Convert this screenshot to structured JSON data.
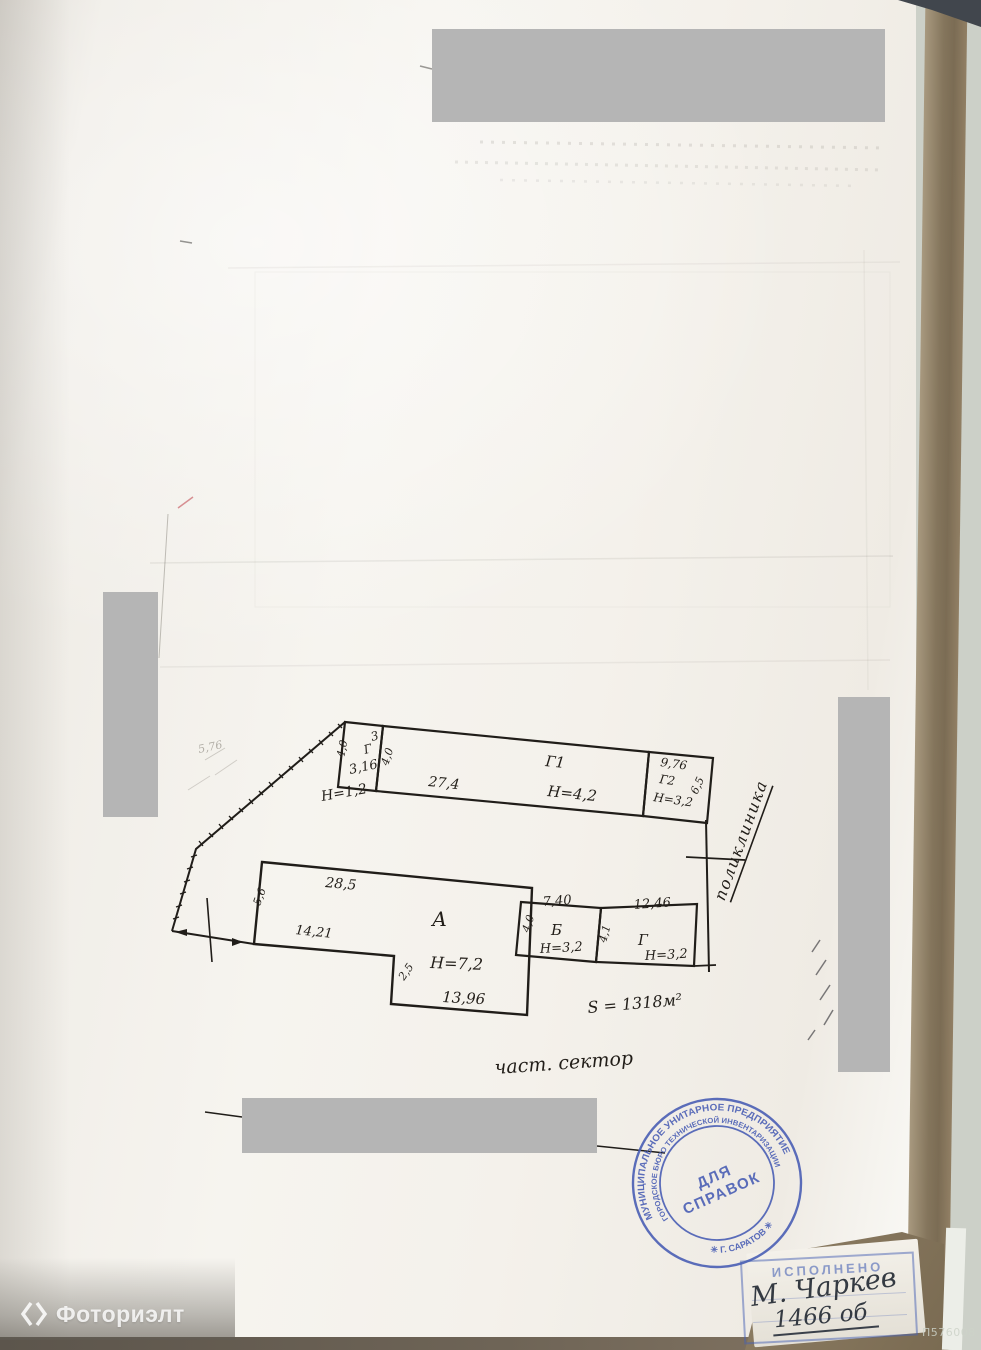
{
  "scan": {
    "code": "П576008"
  },
  "watermark": {
    "brand": "Фоториэлт"
  },
  "plan": {
    "shed3": {
      "num": "3",
      "letter": "Г",
      "width": "3,16",
      "side_left": "4,0",
      "side_right": "4,0",
      "height": "Н=1,2"
    },
    "g1": {
      "label": "Г1",
      "length": "27,4",
      "height": "Н=4,2"
    },
    "g2": {
      "label": "Г2",
      "width": "9,76",
      "height": "Н=3,2",
      "side": "6,5"
    },
    "a": {
      "label": "А",
      "top": "28,5",
      "left": "5,6",
      "offset": "14,21",
      "height": "Н=7,2",
      "bottom": "13,96",
      "step": "2,5"
    },
    "b": {
      "label": "Б",
      "top": "7,40",
      "side": "4,0",
      "height": "Н=3,2"
    },
    "g": {
      "label": "Г",
      "top": "12,46",
      "side": "4,1",
      "height": "Н=3,2"
    },
    "notes": {
      "area": "S = 1318м²",
      "sector": "част. сектор",
      "street": "поликлиника",
      "pencil": "5,76"
    }
  },
  "round_stamp": {
    "ring_outer": "МУНИЦИПАЛЬНОЕ УНИТАРНОЕ ПРЕДПРИЯТИЕ",
    "ring_inner": "ГОРОДСКОЕ БЮРО ТЕХНИЧЕСКОЙ ИНВЕНТАРИЗАЦИИ",
    "bottom": "✳   Г. САРАТОВ   ✳",
    "center_line1": "ДЛЯ",
    "center_line2": "СПРАВОК"
  },
  "rect_stamp": {
    "title": "ИСПОЛНЕНО",
    "signature": "М. Чаркев",
    "number": "1466 об"
  },
  "colors": {
    "stamp_blue": "#4a5fb5",
    "redaction_gray": "#b5b5b5",
    "ink": "#201d19",
    "paper": "#f2efe9"
  }
}
